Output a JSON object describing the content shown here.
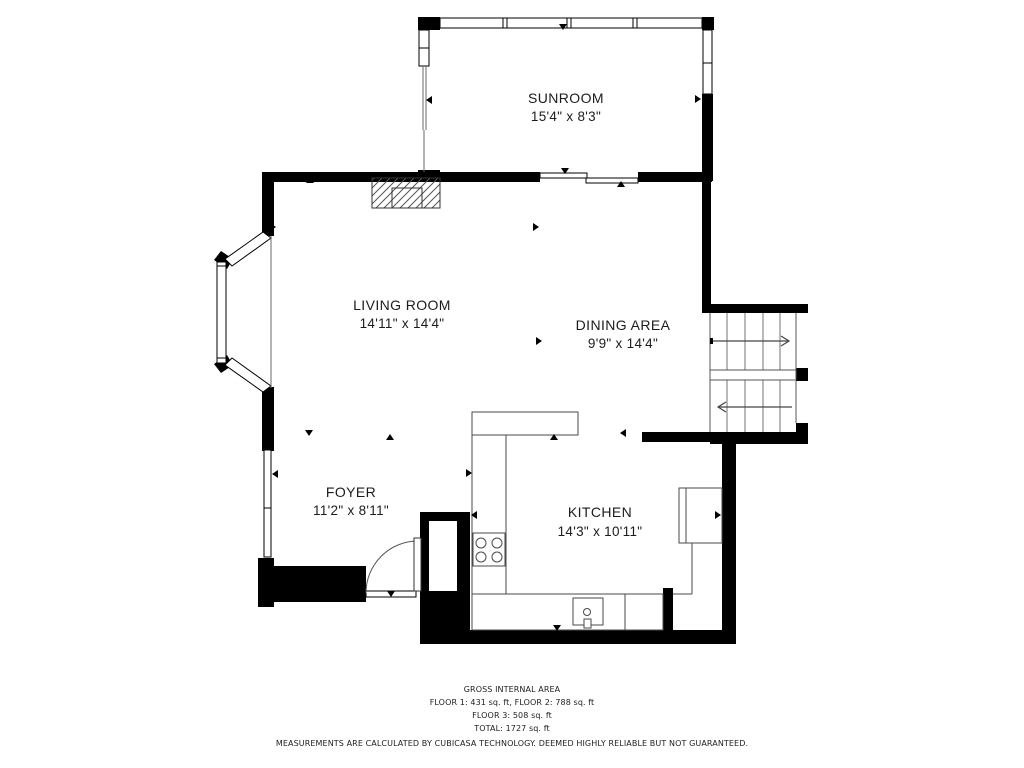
{
  "floorplan": {
    "rooms": {
      "sunroom": {
        "name": "SUNROOM",
        "dims": "15'4\" x 8'3\""
      },
      "living_room": {
        "name": "LIVING ROOM",
        "dims": "14'11\" x 14'4\""
      },
      "dining_area": {
        "name": "DINING AREA",
        "dims": "9'9\" x 14'4\""
      },
      "foyer": {
        "name": "FOYER",
        "dims": "11'2\" x 8'11\""
      },
      "kitchen": {
        "name": "KITCHEN",
        "dims": "14'3\" x 10'11\""
      }
    },
    "footer": {
      "line1": "GROSS INTERNAL AREA",
      "line2": "FLOOR 1: 431 sq. ft, FLOOR 2: 788 sq. ft",
      "line3": "FLOOR 3: 508 sq. ft",
      "line4": "TOTAL: 1727 sq. ft",
      "disclaimer": "MEASUREMENTS ARE CALCULATED BY CUBICASA TECHNOLOGY. DEEMED HIGHLY RELIABLE BUT NOT GUARANTEED."
    },
    "colors": {
      "wall": "#000000",
      "thin_line": "#4a4a4a",
      "stair_step": "#8a8a8a",
      "background": "#ffffff"
    }
  }
}
